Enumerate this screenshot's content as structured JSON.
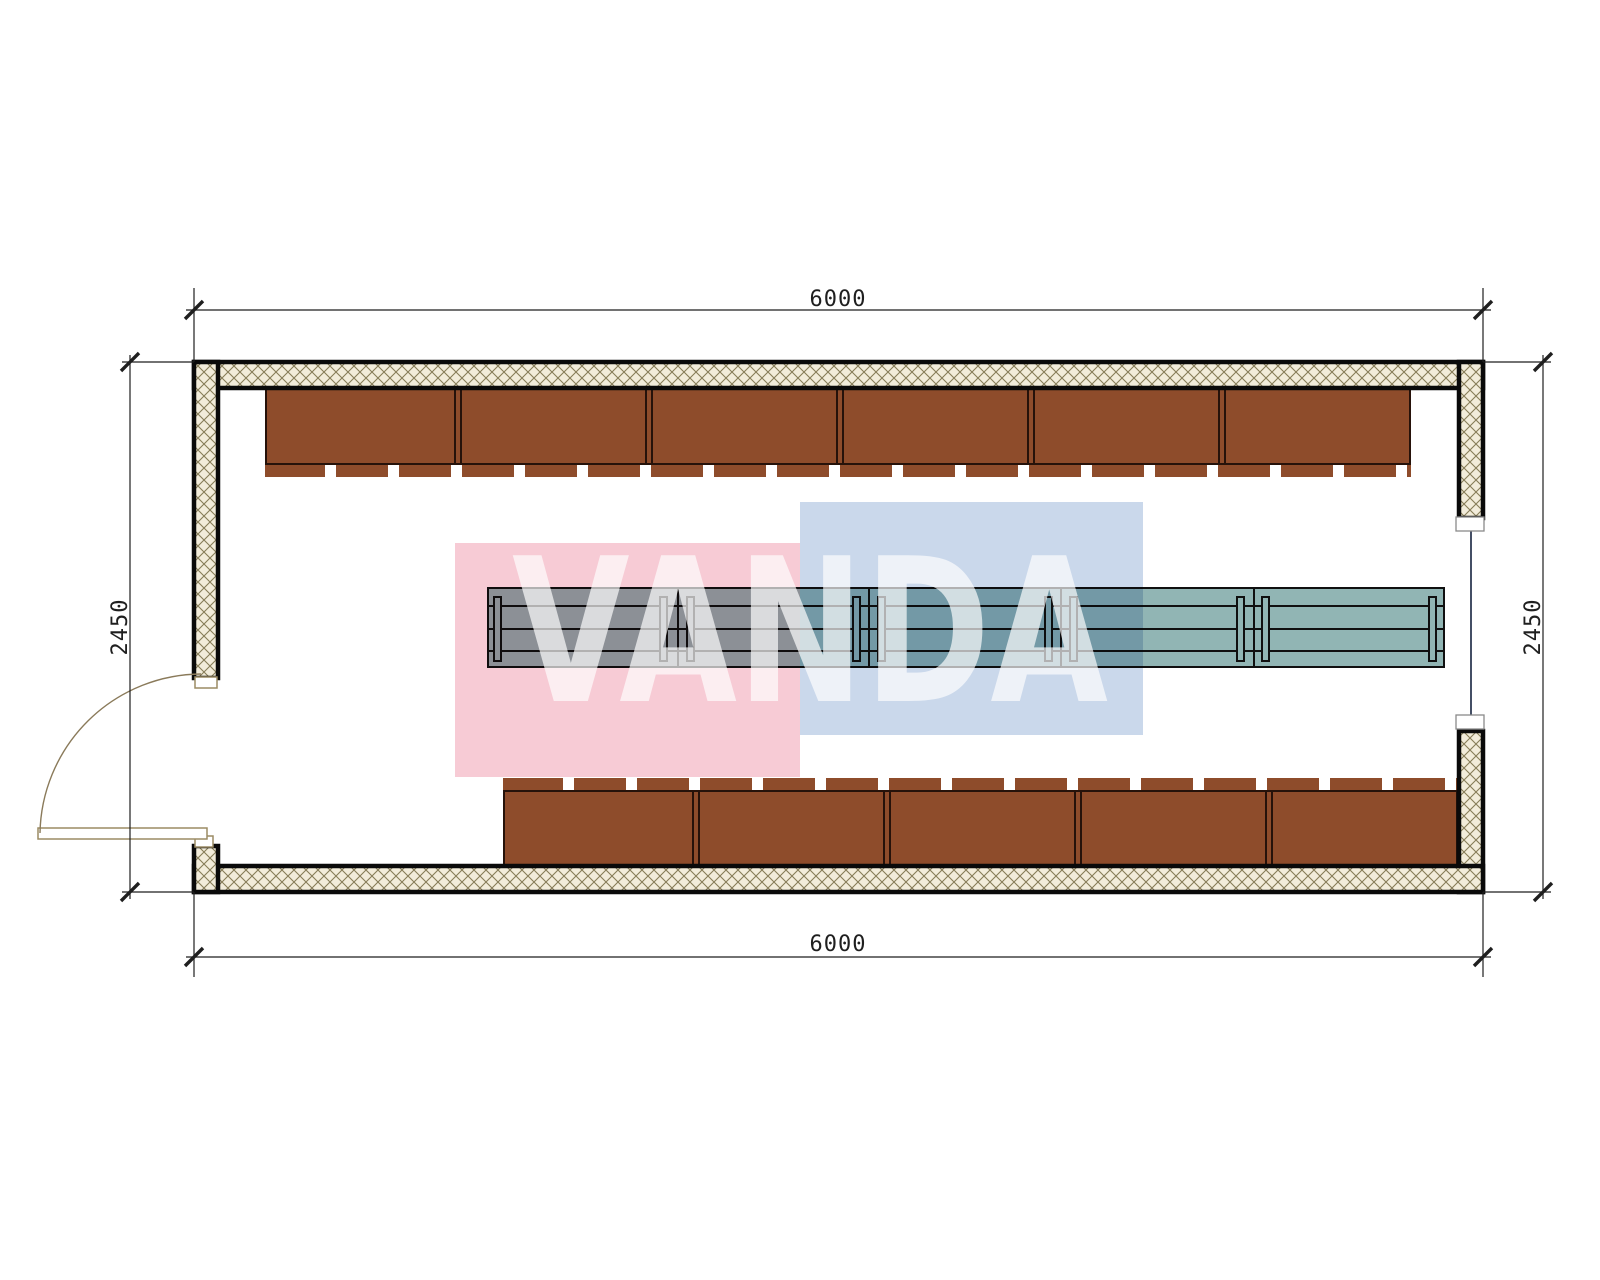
{
  "title": "container-room-floor-plan",
  "dimensions": {
    "width_top": "6000",
    "width_bottom": "6000",
    "depth_left": "2450",
    "depth_right": "2450"
  },
  "watermark": {
    "text": "VANDA"
  },
  "plan": {
    "top_bench_units": 6,
    "bottom_bench_units": 5,
    "table_segments": 5,
    "table_legs": 10,
    "door_location": "left",
    "window_location": "right"
  },
  "theme": {
    "pink": "#f7cbd5",
    "blue": "#cad8eb",
    "bench": "#8e4c2b",
    "bench_border": "#26120a",
    "table": "#91b5b4",
    "table_line": "#101010",
    "hatch_bg": "#f2ecda",
    "hatch_line": "#867c58",
    "wall_stroke": "#0a0a0a",
    "dim": "#1f1f1f",
    "door": "#9b8b64",
    "arc": "#8a7a5a",
    "window_line": "#16233f",
    "window_cap": "#8a8a8a",
    "white": "#ffffff"
  }
}
